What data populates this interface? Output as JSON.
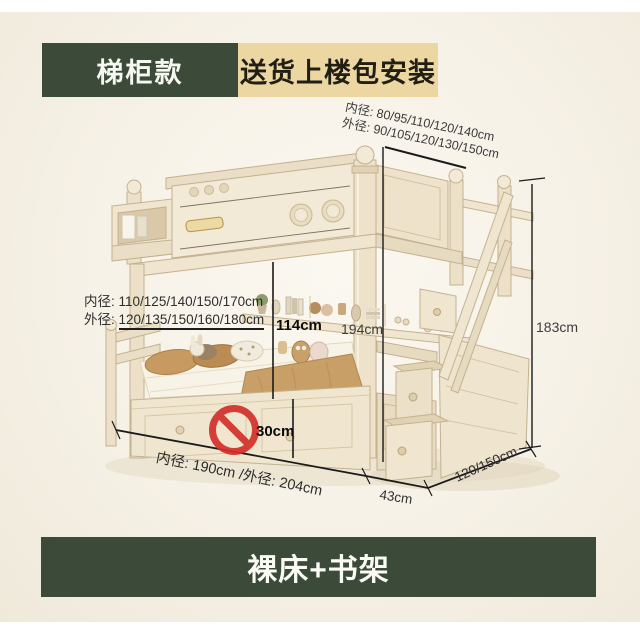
{
  "page": {
    "colors": {
      "background": "#f6f1e6",
      "accent_green": "#3c4a39",
      "accent_tan": "#ecd7a3",
      "accent_red": "#d2302a",
      "wood_cream": "#f2e9d6",
      "dimension_line": "#1b1b1b"
    }
  },
  "header": {
    "model_label": "梯柜款",
    "promo_label": "送货上楼包安装"
  },
  "footer": {
    "label": "裸床+书架"
  },
  "annotations": {
    "top_right_line1": "内径: 80/95/110/120/140cm",
    "top_right_line2": "外径: 90/105/120/130/150cm",
    "left_label1": "内径:",
    "left_value1": "110/125/140/150/170cm",
    "left_label2": "外径:",
    "left_value2": "120/135/150/160/180cm",
    "upper_clearance": "114cm",
    "mid_height": "194cm",
    "total_height": "183cm",
    "under_bed_height": "30cm",
    "bottom_length": "内径: 190cm /外径: 204cm",
    "stair_depth": "43cm",
    "stair_width": "120/150cm"
  },
  "icons": {
    "prohibition": "no-sign"
  }
}
